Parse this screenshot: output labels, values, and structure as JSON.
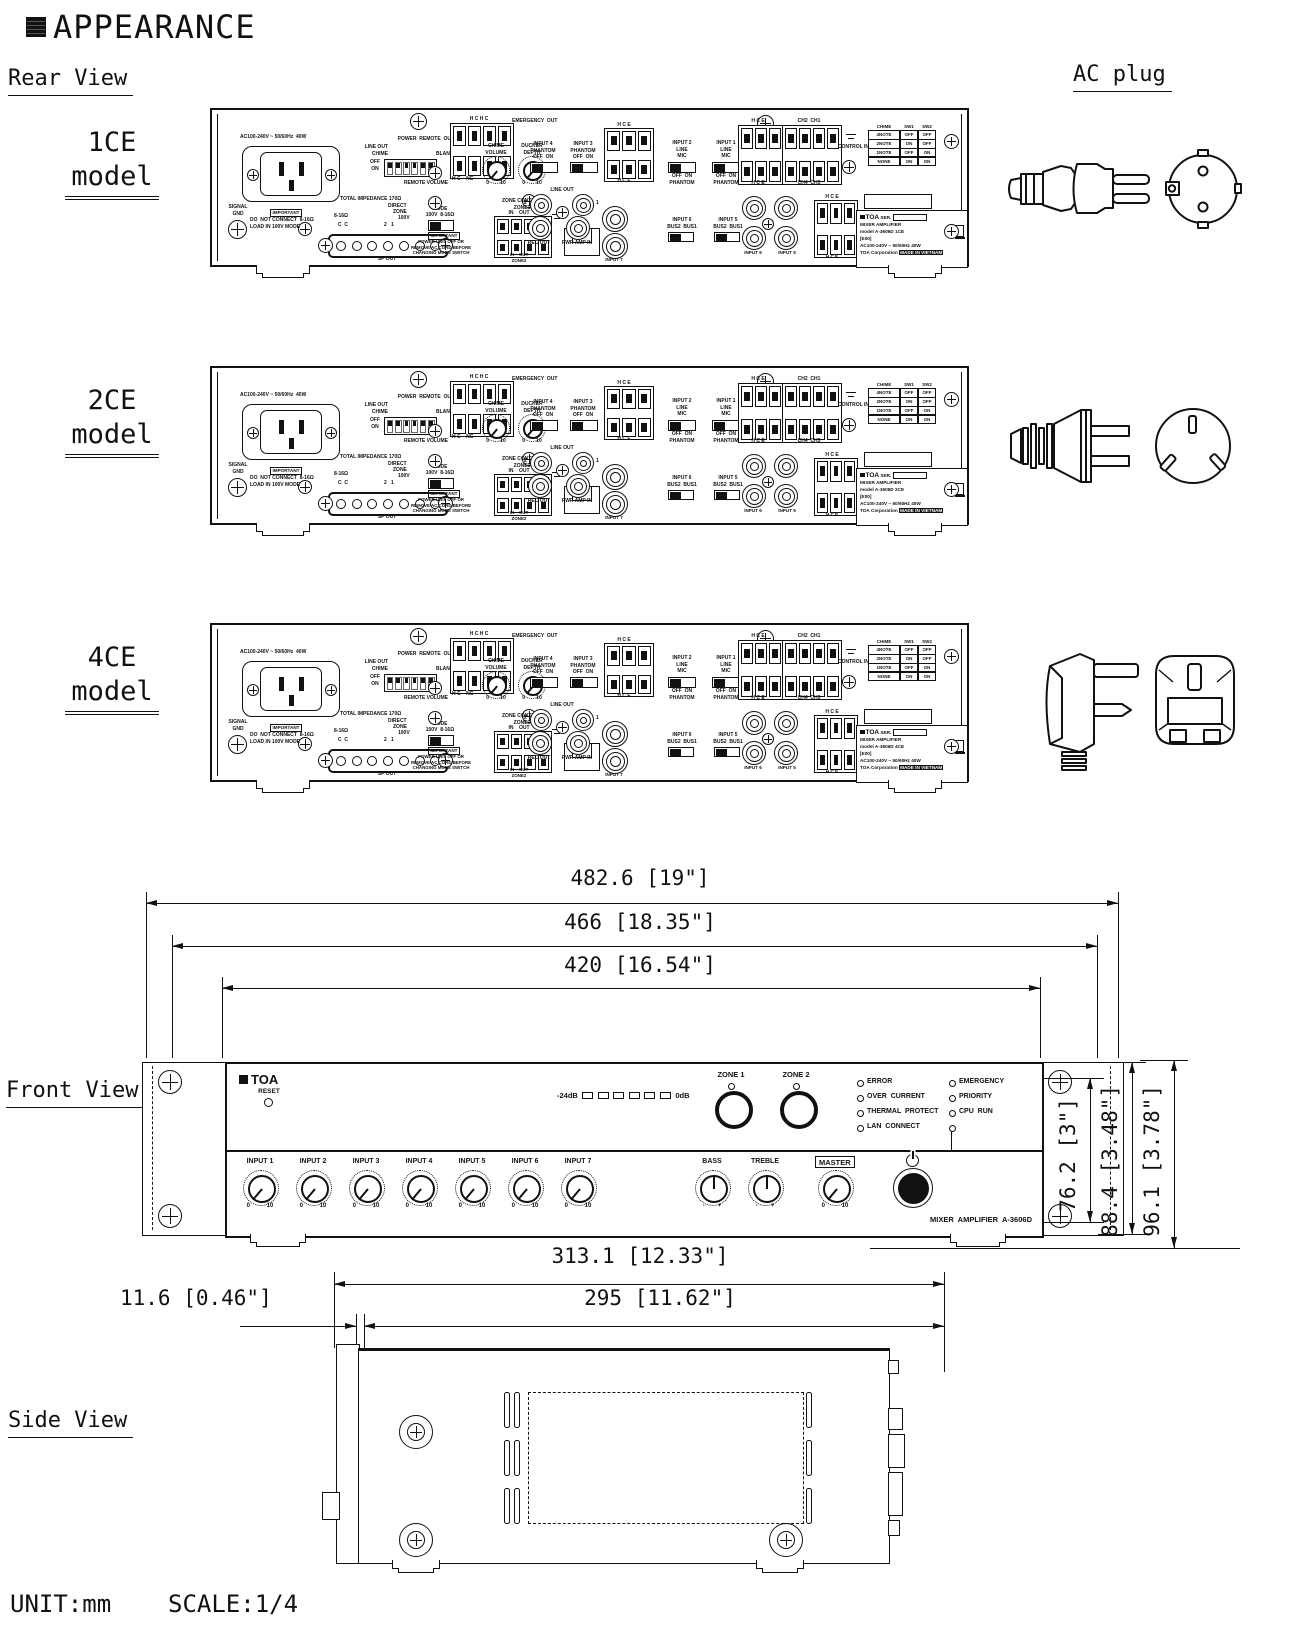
{
  "headings": {
    "title": "APPEARANCE",
    "rear_view": "Rear View",
    "ac_plug": "AC plug",
    "front_view": "Front View",
    "side_view": "Side View"
  },
  "footer": {
    "unit": "UNIT:mm",
    "scale": "SCALE:1/4"
  },
  "rear": {
    "models": [
      {
        "size": "1CE",
        "word": "model",
        "plate_model": "model A-3606D 1CE"
      },
      {
        "size": "2CE",
        "word": "model",
        "plate_model": "model A-3606D 2CE"
      },
      {
        "size": "4CE",
        "word": "model",
        "plate_model": "model A-3606D 4CE"
      }
    ],
    "t": {
      "rating": "AC100-240V ~ 50/60Hz  40W",
      "power_remote_out": "POWER  REMOTE  OUT",
      "hchc": "H C H C",
      "emergency_out": "EMERGENCY  OUT",
      "line_out": "LINE OUT",
      "chime": "CHIME",
      "blank": "BLANK",
      "off_on_v": "OFF\nON",
      "remote_volume": "REMOTE VOLUME",
      "hc_nc": "H C    NC",
      "chime_volume": "CHIME\nVOLUME",
      "ducker_depth": "DUCKER\nDEPTH",
      "zero_ten": "0        10",
      "input4": "INPUT 4\nPHANTOM\nOFF  ON",
      "input3": "INPUT 3\nPHANTOM\nOFF  ON",
      "hce": "H C E",
      "input2": "INPUT 2\nLINE\nMIC",
      "input1": "INPUT 1\nLINE\nMIC",
      "off_on_phantom": "OFF  ON\nPHANTOM",
      "ch2ch1": "CH2  CH1",
      "ch4ch3": "CH4  CH3",
      "control_in": "CONTROL IN",
      "j2": "2",
      "j1": "1",
      "line_out_jacks": "LINE OUT",
      "rec_out": "REC OUT",
      "pwr_amp_in": "PWR AMP IN",
      "input7": "INPUT 7",
      "input6_bus": "INPUT 6\nBUS2  BUS1",
      "input5_bus": "INPUT 5\nBUS2  BUS1",
      "input6": "INPUT 6",
      "input5": "INPUT 5",
      "total_imp": "TOTAL IMPEDANCE 170Ω",
      "direct": "DIRECT",
      "zone": "ZONE",
      "v100": "100V",
      "ohm": "8-16Ω",
      "cc": "C  C",
      "two_one": "2   1",
      "mode": "MODE",
      "mode_opts": "100V  8-16Ω",
      "important": "IMPORTANT",
      "warn1": "DO  NOT CONNECT  8-16Ω\nLOAD IN 100V MODE",
      "warn2": "POWER UNIT OFF OR\nREMOVE AC CORD BEFORE\nCHANGING MODE SWITCH",
      "signal_gnd": "SIGNAL\nGND",
      "sp_out": "SP OUT",
      "zone_control": "ZONE CONTROL\nZONE1",
      "in_out": "IN    OUT",
      "in_out_zone2": "IN    OUT\nZONE2",
      "lan": "LAN",
      "chime_hdr": [
        "CHIME",
        "SW1",
        "SW2"
      ],
      "chime_rows": [
        [
          "4NOTE",
          "OFF",
          "OFF"
        ],
        [
          "2NOTE",
          "ON",
          "OFF"
        ],
        [
          "1NOTE",
          "OFF",
          "ON"
        ],
        [
          "NONE",
          "ON",
          "ON"
        ]
      ],
      "plate": {
        "brand": "TOA",
        "ser": "SER.",
        "product": "MIXER  AMPLIFIER",
        "e00": "[E00]",
        "rating": "AC100-240V ~ 50/60Hz  40W",
        "corp": "TOA  Corporation",
        "made": "MADE IN VIETNAM",
        "ce": "CE"
      }
    }
  },
  "front": {
    "brand": "TOA",
    "reset": "RESET",
    "meter_l": "-24dB",
    "meter_r": "0dB",
    "zone1": "ZONE 1",
    "zone2": "ZONE 2",
    "leds1": [
      "ERROR",
      "OVER  CURRENT",
      "THERMAL  PROTECT",
      "LAN  CONNECT"
    ],
    "leds2": [
      "EMERGENCY",
      "PRIORITY",
      "CPU  RUN"
    ],
    "inputs": [
      "INPUT 1",
      "INPUT 2",
      "INPUT 3",
      "INPUT 4",
      "INPUT 5",
      "INPUT 6",
      "INPUT 7"
    ],
    "bass": "BASS",
    "treble": "TREBLE",
    "master": "MASTER",
    "s010": "0          10",
    "smp": "-        +",
    "model": "MIXER  AMPLIFIER  A-3606D"
  },
  "dims": {
    "w1": "482.6 [19\"]",
    "w2": "466 [18.35\"]",
    "w3": "420 [16.54\"]",
    "h1": "76.2 [3\"]",
    "h2": "88.4 [3.48\"]",
    "h3": "96.1 [3.78\"]",
    "d1": "313.1 [12.33\"]",
    "d2": "11.6 [0.46\"]",
    "d3": "295 [11.62\"]"
  }
}
